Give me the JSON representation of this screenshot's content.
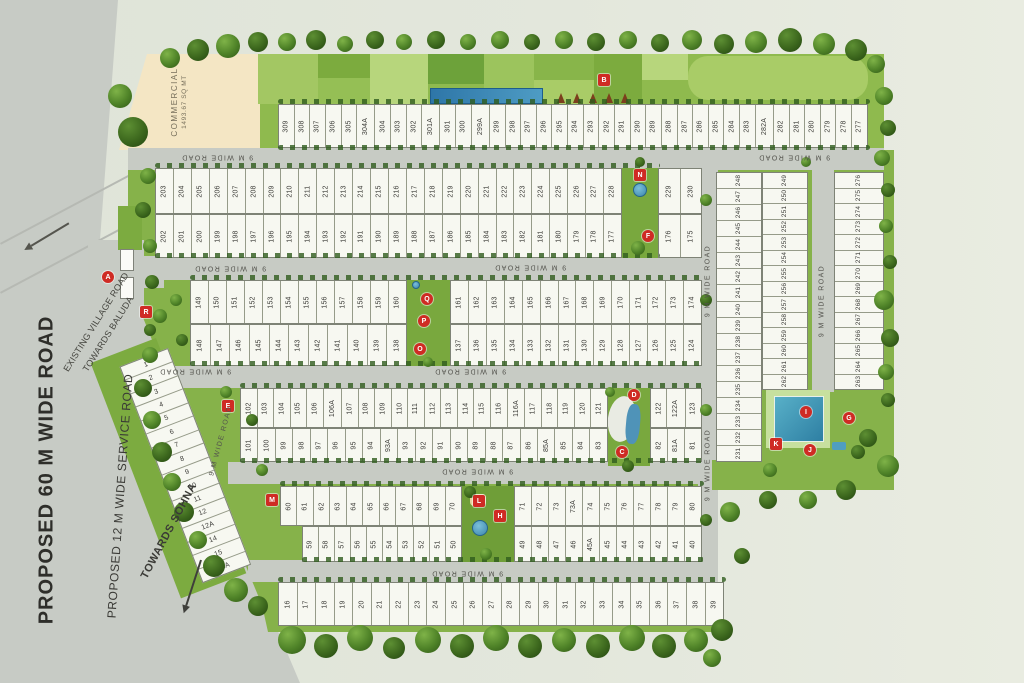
{
  "commercial": {
    "line1": "COMMERCIAL",
    "line2": "1493.67 SQ MT"
  },
  "community": {
    "line1": "COMMUNITY FACILITIES",
    "line2": "LAND : 1.5968 ACRES"
  },
  "road_labels": [
    {
      "text": "9 M WIDE ROAD",
      "x": 217,
      "y": 157,
      "rot": 180,
      "cls": "sm"
    },
    {
      "text": "9 M WIDE ROAD",
      "x": 794,
      "y": 157,
      "rot": 180,
      "cls": "sm"
    },
    {
      "text": "9 M WIDE ROAD",
      "x": 230,
      "y": 268,
      "rot": 180,
      "cls": "sm"
    },
    {
      "text": "9 M WIDE ROAD",
      "x": 530,
      "y": 267,
      "rot": 180,
      "cls": "sm"
    },
    {
      "text": "9 M WIDE ROAD",
      "x": 195,
      "y": 371,
      "rot": 180,
      "cls": "sm"
    },
    {
      "text": "9 M WIDE ROAD",
      "x": 470,
      "y": 371,
      "rot": 180,
      "cls": "sm"
    },
    {
      "text": "9 M WIDE ROAD",
      "x": 477,
      "y": 471,
      "rot": 180,
      "cls": "sm"
    },
    {
      "text": "9 M WIDE ROAD",
      "x": 467,
      "y": 573,
      "rot": 180,
      "cls": "sm"
    },
    {
      "text": "9 M WIDE ROAD",
      "x": 708,
      "y": 281,
      "rot": -90,
      "cls": "sm"
    },
    {
      "text": "9 M WIDE ROAD",
      "x": 708,
      "y": 465,
      "rot": -90,
      "cls": "sm"
    },
    {
      "text": "9 M WIDE ROAD",
      "x": 822,
      "y": 301,
      "rot": -90,
      "cls": "sm"
    },
    {
      "text": "9 M WIDE ROAD",
      "x": 221,
      "y": 441,
      "rot": -75,
      "cls": "sm"
    },
    {
      "text": "PROPOSED 60 M WIDE ROAD",
      "x": 47,
      "y": 470,
      "rot": -90,
      "cls": "big"
    },
    {
      "text": "PROPOSED 12 M  WIDE SERVICE ROAD",
      "x": 120,
      "y": 496,
      "rot": -86,
      "cls": "mid"
    },
    {
      "text": "TOWARDS SOHNA",
      "x": 169,
      "y": 531,
      "rot": -62,
      "cls": "sohna"
    },
    {
      "text": "EXISTING VILLAGE ROAD",
      "x": 96,
      "y": 322,
      "rot": -58,
      "cls": "tiny"
    },
    {
      "text": "TOWARDS BALUDA",
      "x": 108,
      "y": 334,
      "rot": -58,
      "cls": "tiny"
    }
  ],
  "markers": [
    {
      "label": "A",
      "x": 108,
      "y": 277,
      "shape": "circle"
    },
    {
      "label": "B",
      "x": 604,
      "y": 80,
      "shape": "square"
    },
    {
      "label": "C",
      "x": 622,
      "y": 452,
      "shape": "circle"
    },
    {
      "label": "D",
      "x": 634,
      "y": 395,
      "shape": "circle"
    },
    {
      "label": "E",
      "x": 228,
      "y": 406,
      "shape": "square"
    },
    {
      "label": "F",
      "x": 648,
      "y": 236,
      "shape": "circle"
    },
    {
      "label": "G",
      "x": 849,
      "y": 418,
      "shape": "circle"
    },
    {
      "label": "H",
      "x": 500,
      "y": 516,
      "shape": "square"
    },
    {
      "label": "I",
      "x": 806,
      "y": 412,
      "shape": "circle"
    },
    {
      "label": "J",
      "x": 810,
      "y": 450,
      "shape": "circle"
    },
    {
      "label": "K",
      "x": 776,
      "y": 444,
      "shape": "square"
    },
    {
      "label": "L",
      "x": 479,
      "y": 501,
      "shape": "square"
    },
    {
      "label": "M",
      "x": 272,
      "y": 500,
      "shape": "square"
    },
    {
      "label": "N",
      "x": 640,
      "y": 175,
      "shape": "square"
    },
    {
      "label": "O",
      "x": 420,
      "y": 349,
      "shape": "circle"
    },
    {
      "label": "P",
      "x": 424,
      "y": 321,
      "shape": "circle"
    },
    {
      "label": "Q",
      "x": 427,
      "y": 299,
      "shape": "circle"
    },
    {
      "label": "R",
      "x": 146,
      "y": 312,
      "shape": "square"
    }
  ],
  "plot_rows": [
    {
      "name": "277-309",
      "x": 278,
      "y": 104,
      "w": 590,
      "h": 44,
      "nums": [
        "309",
        "308",
        "307",
        "306",
        "305",
        "304A",
        "304",
        "303",
        "302",
        "301A",
        "301",
        "300",
        "299A",
        "299",
        "298",
        "297",
        "296",
        "295",
        "294",
        "293",
        "292",
        "291",
        "290",
        "289",
        "288",
        "287",
        "286",
        "285",
        "284",
        "283",
        "282A",
        "282",
        "281",
        "280",
        "279",
        "278",
        "277"
      ]
    },
    {
      "name": "203-228",
      "x": 155,
      "y": 168,
      "w": 467,
      "h": 46,
      "nums": [
        "203",
        "204",
        "205",
        "206",
        "207",
        "208",
        "209",
        "210",
        "211",
        "212",
        "213",
        "214",
        "215",
        "216",
        "217",
        "218",
        "219",
        "220",
        "221",
        "222",
        "223",
        "224",
        "225",
        "226",
        "227",
        "228"
      ]
    },
    {
      "name": "229-230",
      "x": 658,
      "y": 168,
      "w": 44,
      "h": 46,
      "nums": [
        "229",
        "230"
      ]
    },
    {
      "name": "177-202",
      "x": 155,
      "y": 214,
      "w": 467,
      "h": 44,
      "nums": [
        "202",
        "201",
        "200",
        "199",
        "198",
        "197",
        "196",
        "195",
        "194",
        "193",
        "192",
        "191",
        "190",
        "189",
        "188",
        "187",
        "186",
        "185",
        "184",
        "183",
        "182",
        "181",
        "180",
        "179",
        "178",
        "177"
      ]
    },
    {
      "name": "175-176",
      "x": 658,
      "y": 214,
      "w": 44,
      "h": 44,
      "nums": [
        "176",
        "175"
      ]
    },
    {
      "name": "149-160",
      "x": 190,
      "y": 280,
      "w": 217,
      "h": 44,
      "nums": [
        "149",
        "150",
        "151",
        "152",
        "153",
        "154",
        "155",
        "156",
        "157",
        "158",
        "159",
        "160"
      ]
    },
    {
      "name": "161-174",
      "x": 450,
      "y": 280,
      "w": 252,
      "h": 44,
      "nums": [
        "161",
        "162",
        "163",
        "164",
        "165",
        "166",
        "167",
        "168",
        "169",
        "170",
        "171",
        "172",
        "173",
        "174"
      ]
    },
    {
      "name": "138-148",
      "x": 190,
      "y": 324,
      "w": 217,
      "h": 42,
      "nums": [
        "148",
        "147",
        "146",
        "145",
        "144",
        "143",
        "142",
        "141",
        "140",
        "139",
        "138"
      ]
    },
    {
      "name": "124-137",
      "x": 450,
      "y": 324,
      "w": 252,
      "h": 42,
      "nums": [
        "137",
        "136",
        "135",
        "134",
        "133",
        "132",
        "131",
        "130",
        "129",
        "128",
        "127",
        "126",
        "125",
        "124"
      ]
    },
    {
      "name": "102-121",
      "x": 240,
      "y": 388,
      "w": 368,
      "h": 40,
      "nums": [
        "102",
        "103",
        "104",
        "105",
        "106",
        "106A",
        "107",
        "108",
        "109",
        "110",
        "111",
        "112",
        "113",
        "114",
        "115",
        "116",
        "116A",
        "117",
        "118",
        "119",
        "120",
        "121"
      ]
    },
    {
      "name": "122-123",
      "x": 650,
      "y": 388,
      "w": 52,
      "h": 40,
      "nums": [
        "122",
        "122A",
        "123"
      ]
    },
    {
      "name": "83-101",
      "x": 240,
      "y": 428,
      "w": 368,
      "h": 34,
      "nums": [
        "101",
        "100",
        "99",
        "98",
        "97",
        "96",
        "95",
        "94",
        "93A",
        "93",
        "92",
        "91",
        "90",
        "89",
        "88",
        "87",
        "86",
        "85A",
        "85",
        "84",
        "83"
      ]
    },
    {
      "name": "81-82",
      "x": 650,
      "y": 428,
      "w": 52,
      "h": 34,
      "nums": [
        "82",
        "81A",
        "81"
      ]
    },
    {
      "name": "60-70",
      "x": 280,
      "y": 486,
      "w": 182,
      "h": 40,
      "nums": [
        "60",
        "61",
        "62",
        "63",
        "64",
        "65",
        "66",
        "67",
        "68",
        "69",
        "70"
      ]
    },
    {
      "name": "71-80",
      "x": 514,
      "y": 486,
      "w": 188,
      "h": 40,
      "nums": [
        "71",
        "72",
        "73",
        "73A",
        "74",
        "75",
        "76",
        "77",
        "78",
        "79",
        "80"
      ]
    },
    {
      "name": "50-59",
      "x": 302,
      "y": 526,
      "w": 160,
      "h": 36,
      "nums": [
        "59",
        "58",
        "57",
        "56",
        "55",
        "54",
        "53",
        "52",
        "51",
        "50"
      ]
    },
    {
      "name": "40-49",
      "x": 514,
      "y": 526,
      "w": 188,
      "h": 36,
      "nums": [
        "49",
        "48",
        "47",
        "46",
        "45A",
        "45",
        "44",
        "43",
        "42",
        "41",
        "40"
      ]
    },
    {
      "name": "16-39",
      "x": 278,
      "y": 582,
      "w": 446,
      "h": 44,
      "nums": [
        "16",
        "17",
        "18",
        "19",
        "20",
        "21",
        "22",
        "23",
        "24",
        "25",
        "26",
        "27",
        "28",
        "29",
        "30",
        "31",
        "32",
        "33",
        "34",
        "35",
        "36",
        "37",
        "38",
        "39"
      ]
    },
    {
      "name": "231-248",
      "x": 716,
      "y": 172,
      "w": 46,
      "h": 290,
      "dir": "v",
      "fs": 6.5,
      "nums": [
        "248",
        "247",
        "246",
        "245",
        "244",
        "243",
        "242",
        "241",
        "240",
        "239",
        "238",
        "237",
        "236",
        "235",
        "234",
        "233",
        "232",
        "231"
      ]
    },
    {
      "name": "249-262",
      "x": 762,
      "y": 172,
      "w": 46,
      "h": 218,
      "dir": "v",
      "fs": 6.5,
      "nums": [
        "249",
        "250",
        "251",
        "252",
        "253",
        "254",
        "255",
        "256",
        "257",
        "258",
        "259",
        "260",
        "261",
        "262"
      ]
    },
    {
      "name": "263-276",
      "x": 834,
      "y": 172,
      "w": 50,
      "h": 218,
      "dir": "v",
      "fs": 6.5,
      "nums": [
        "276",
        "275",
        "274",
        "273",
        "272",
        "271",
        "270",
        "269",
        "268",
        "267",
        "266",
        "265",
        "264",
        "263"
      ]
    },
    {
      "name": "1-15A",
      "x": 168,
      "y": 348,
      "w": 232,
      "h": 52,
      "rot": 69,
      "nums": [
        "1",
        "2",
        "3",
        "4",
        "5",
        "6",
        "7",
        "8",
        "9",
        "10",
        "11",
        "12",
        "12A",
        "14",
        "15",
        "15A"
      ]
    }
  ]
}
